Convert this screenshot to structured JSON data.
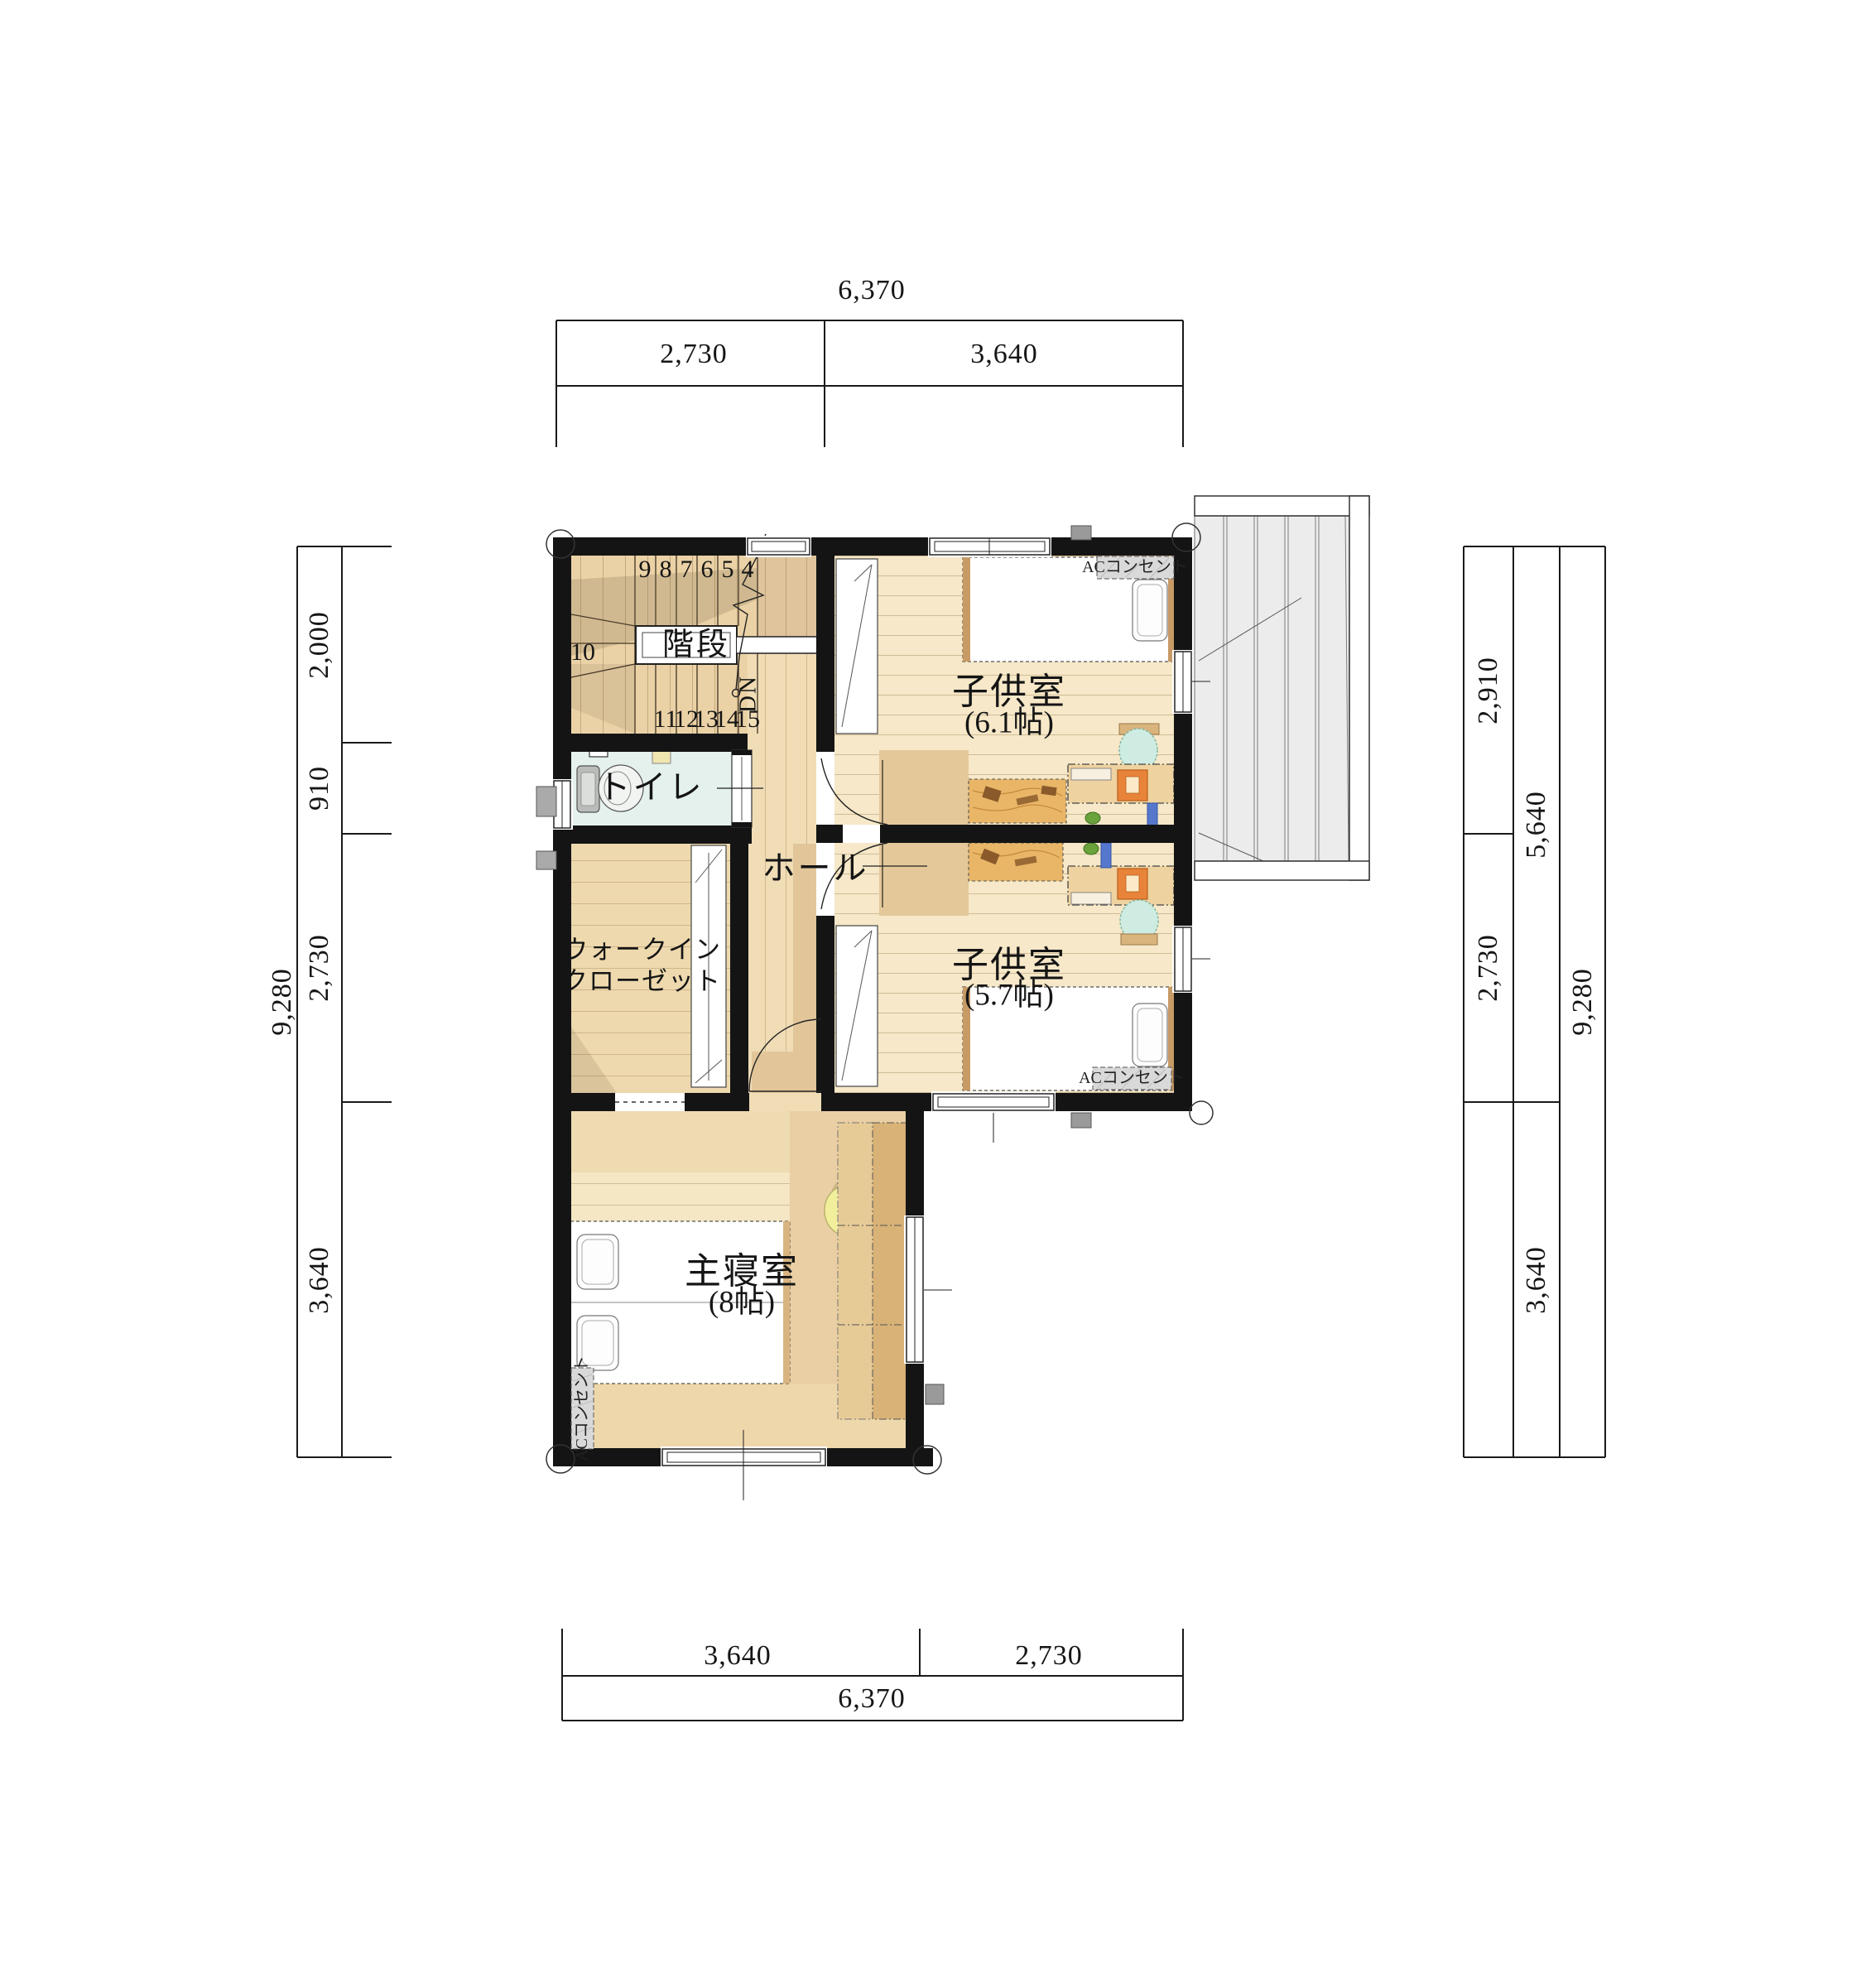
{
  "drawing": {
    "type": "floor-plan-2F",
    "units": "mm"
  },
  "dimensions": {
    "top": {
      "total": "6,370",
      "seg1": "2,730",
      "seg2": "3,640"
    },
    "bottom": {
      "seg1": "3,640",
      "seg2": "2,730",
      "total": "6,370"
    },
    "left": {
      "total": "9,280",
      "seg1": "2,000",
      "seg2": "910",
      "seg3": "2,730",
      "seg4": "3,640"
    },
    "right": {
      "seg1": "2,910",
      "seg2": "2,730",
      "mid1": "5,640",
      "mid2": "3,640",
      "total": "9,280"
    }
  },
  "rooms": {
    "stairs": {
      "label": "階段"
    },
    "toilet": {
      "label": "トイレ"
    },
    "hall": {
      "label": "ホール"
    },
    "wic": {
      "label_line1": "ウォークイン",
      "label_line2": "クローゼット"
    },
    "child1": {
      "label": "子供室",
      "size": "(6.1帖)"
    },
    "child2": {
      "label": "子供室",
      "size": "(5.7帖)"
    },
    "master": {
      "label": "主寝室",
      "size": "(8帖)"
    }
  },
  "stairs": {
    "direction": "DN",
    "up1": "9",
    "up2": "8",
    "up3": "7",
    "up4": "6",
    "up5": "5",
    "up6": "4",
    "mid": "10",
    "dn1": "11",
    "dn2": "12",
    "dn3": "13",
    "dn4": "14",
    "dn5": "15"
  },
  "annotations": {
    "ac_outlet": "ACコンセント"
  },
  "colors": {
    "wall": "#141414",
    "floor_light": "#f6e8c8",
    "floor_stair": "#ebd2a6",
    "floor_hall": "#f0ddb6",
    "floor_toilet": "#e4f1ec",
    "balcony_deck": "#ececec",
    "desk_orange": "#e8843a",
    "chair_teal": "#cfece2",
    "stool_yellow": "#f2ef9c",
    "rug": "#e9b668",
    "wardrobe": "#d8b277"
  }
}
